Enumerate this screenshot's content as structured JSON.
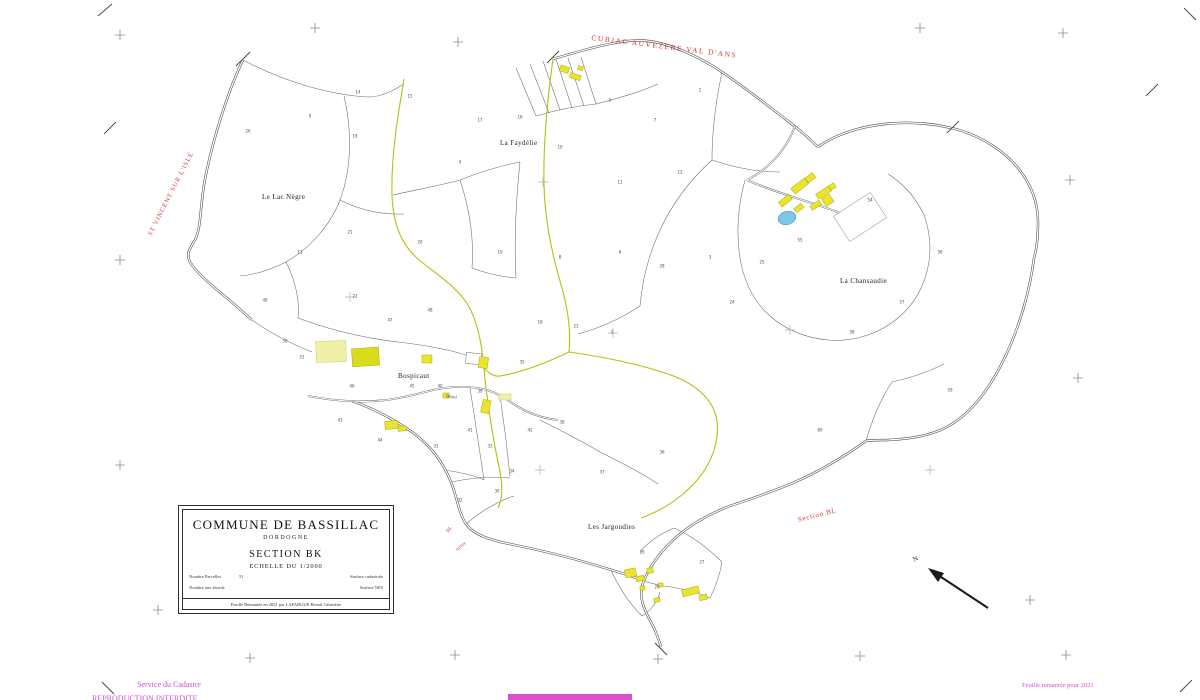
{
  "title_block": {
    "commune": "COMMUNE DE BASSILLAC",
    "departement": "DORDOGNE",
    "section": "SECTION  BK",
    "echelle": "ECHELLE  DU  1/2000",
    "fields": {
      "left1_label": "Nombre Parcelles",
      "left1_value": "51",
      "left2_label": "Nombre aux abords",
      "right1_label": "Surface cadastrale",
      "right2_label": "Surface NFS"
    },
    "footer": "Feuille Remaniée en 2021 par LAFARGUE Benoît Géomètre"
  },
  "adjacent_labels": {
    "north_commune": "CUBJAC  AUVEZERE   VAL  D'ANS",
    "west_commune": "ST VINCENT SUR L'ISLE",
    "south_section": "Section  BL",
    "south_section_small": "BL",
    "south_note": "suivre"
  },
  "place_names": {
    "la_faydelie": "La Faydélie",
    "le_lac_negre": "Le Lac Nègre",
    "la_chansaudie": "La Chansaudie",
    "bospicaut": "Bospicaut",
    "les_jargoudies": "Les Jargoudies",
    "road_beard": "Béard"
  },
  "footer_notes": {
    "service": "Service du Cadastre",
    "reproduction": "REPRODUCTION  INTERDITE",
    "feuille": "Feuille remaniée pour 2021"
  },
  "north_indicator": {
    "label": "N"
  },
  "colors": {
    "building_yellow": "#e9e52e",
    "building_pale": "#f0f1a8",
    "building_olive": "#d9dc1c",
    "pond_blue": "#7cc7e6",
    "section_boundary_olive": "#b9bf10",
    "neighbor_red": "#d23737",
    "note_pink": "#cf4fcf",
    "line_black": "#454545"
  },
  "parcel_numbers": [
    {
      "n": "14",
      "x": 358,
      "y": 92
    },
    {
      "n": "15",
      "x": 410,
      "y": 96
    },
    {
      "n": "9",
      "x": 310,
      "y": 116
    },
    {
      "n": "26",
      "x": 248,
      "y": 131
    },
    {
      "n": "18",
      "x": 355,
      "y": 136
    },
    {
      "n": "16",
      "x": 520,
      "y": 117
    },
    {
      "n": "5",
      "x": 610,
      "y": 100
    },
    {
      "n": "7",
      "x": 655,
      "y": 120
    },
    {
      "n": "4",
      "x": 460,
      "y": 162
    },
    {
      "n": "10",
      "x": 560,
      "y": 147
    },
    {
      "n": "11",
      "x": 620,
      "y": 182
    },
    {
      "n": "12",
      "x": 680,
      "y": 172
    },
    {
      "n": "13",
      "x": 300,
      "y": 252
    },
    {
      "n": "21",
      "x": 350,
      "y": 232
    },
    {
      "n": "20",
      "x": 420,
      "y": 242
    },
    {
      "n": "19",
      "x": 500,
      "y": 252
    },
    {
      "n": "8",
      "x": 560,
      "y": 257
    },
    {
      "n": "6",
      "x": 620,
      "y": 252
    },
    {
      "n": "28",
      "x": 662,
      "y": 266
    },
    {
      "n": "3",
      "x": 710,
      "y": 257
    },
    {
      "n": "22",
      "x": 355,
      "y": 296
    },
    {
      "n": "18",
      "x": 540,
      "y": 322
    },
    {
      "n": "23",
      "x": 576,
      "y": 326
    },
    {
      "n": "2",
      "x": 612,
      "y": 332
    },
    {
      "n": "51",
      "x": 302,
      "y": 357
    },
    {
      "n": "50",
      "x": 285,
      "y": 341
    },
    {
      "n": "46",
      "x": 352,
      "y": 386
    },
    {
      "n": "45",
      "x": 412,
      "y": 386
    },
    {
      "n": "40",
      "x": 440,
      "y": 386
    },
    {
      "n": "39",
      "x": 480,
      "y": 391
    },
    {
      "n": "35",
      "x": 522,
      "y": 362
    },
    {
      "n": "31",
      "x": 436,
      "y": 446
    },
    {
      "n": "33",
      "x": 490,
      "y": 446
    },
    {
      "n": "34",
      "x": 512,
      "y": 471
    },
    {
      "n": "30",
      "x": 497,
      "y": 491
    },
    {
      "n": "24",
      "x": 732,
      "y": 302
    },
    {
      "n": "25",
      "x": 762,
      "y": 262
    },
    {
      "n": "58",
      "x": 852,
      "y": 332
    },
    {
      "n": "57",
      "x": 902,
      "y": 302
    },
    {
      "n": "56",
      "x": 940,
      "y": 252
    },
    {
      "n": "36",
      "x": 662,
      "y": 452
    },
    {
      "n": "37",
      "x": 602,
      "y": 472
    },
    {
      "n": "38",
      "x": 562,
      "y": 422
    },
    {
      "n": "26",
      "x": 642,
      "y": 552
    },
    {
      "n": "27",
      "x": 702,
      "y": 562
    },
    {
      "n": "29",
      "x": 657,
      "y": 587
    },
    {
      "n": "54",
      "x": 870,
      "y": 200
    },
    {
      "n": "55",
      "x": 800,
      "y": 240
    },
    {
      "n": "59",
      "x": 950,
      "y": 390
    },
    {
      "n": "60",
      "x": 820,
      "y": 430
    },
    {
      "n": "47",
      "x": 390,
      "y": 320
    },
    {
      "n": "48",
      "x": 430,
      "y": 310
    },
    {
      "n": "41",
      "x": 470,
      "y": 430
    },
    {
      "n": "42",
      "x": 530,
      "y": 430
    },
    {
      "n": "17",
      "x": 480,
      "y": 120
    },
    {
      "n": "1",
      "x": 700,
      "y": 90
    },
    {
      "n": "32",
      "x": 460,
      "y": 500
    },
    {
      "n": "44",
      "x": 380,
      "y": 440
    },
    {
      "n": "43",
      "x": 340,
      "y": 420
    },
    {
      "n": "49",
      "x": 265,
      "y": 300
    }
  ]
}
